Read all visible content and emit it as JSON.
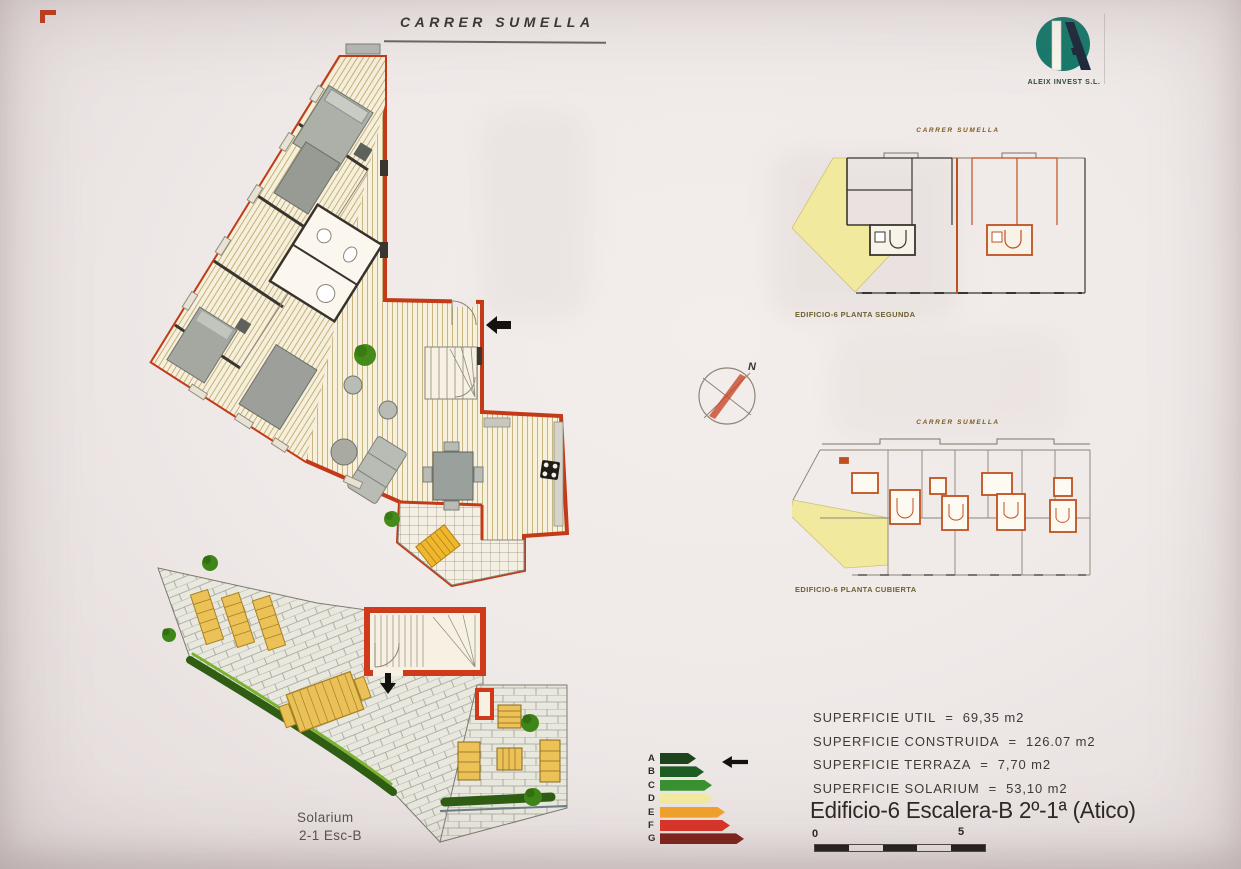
{
  "header": {
    "street": "CARRER SUMELLA"
  },
  "logo": {
    "company": "ALEIX INVEST S.L."
  },
  "compass": {
    "north": "N"
  },
  "small_plans": [
    {
      "street": "CARRER SUMELLA",
      "caption": "EDIFICIO-6 PLANTA SEGUNDA"
    },
    {
      "street": "CARRER SUMELLA",
      "caption": "EDIFICIO-6 PLANTA CUBIERTA"
    }
  ],
  "solarium": {
    "line1": "Solarium",
    "line2": "2-1 Esc-B"
  },
  "energy_label": {
    "ratings": [
      {
        "letter": "A",
        "color": "#1e441d",
        "width": 36
      },
      {
        "letter": "B",
        "color": "#1d5c22",
        "width": 44
      },
      {
        "letter": "C",
        "color": "#3a9132",
        "width": 52
      },
      {
        "letter": "D",
        "color": "#f1eca1",
        "width": 53
      },
      {
        "letter": "E",
        "color": "#f2a22c",
        "width": 65
      },
      {
        "letter": "F",
        "color": "#da3428",
        "width": 70
      },
      {
        "letter": "G",
        "color": "#7e2019",
        "width": 84
      }
    ]
  },
  "surfaces": {
    "separator": "=",
    "items": [
      {
        "label": "SUPERFICIE UTIL",
        "value": "69,35  m2"
      },
      {
        "label": "SUPERFICIE CONSTRUIDA",
        "value": "126.07  m2"
      },
      {
        "label": "SUPERFICIE TERRAZA",
        "value": "7,70  m2"
      },
      {
        "label": "SUPERFICIE SOLARIUM",
        "value": "53,10  m2"
      }
    ],
    "title": "Edificio-6 Escalera-B 2º-1ª (Atico)"
  },
  "scale_bar": {
    "start": "0",
    "end": "5"
  }
}
